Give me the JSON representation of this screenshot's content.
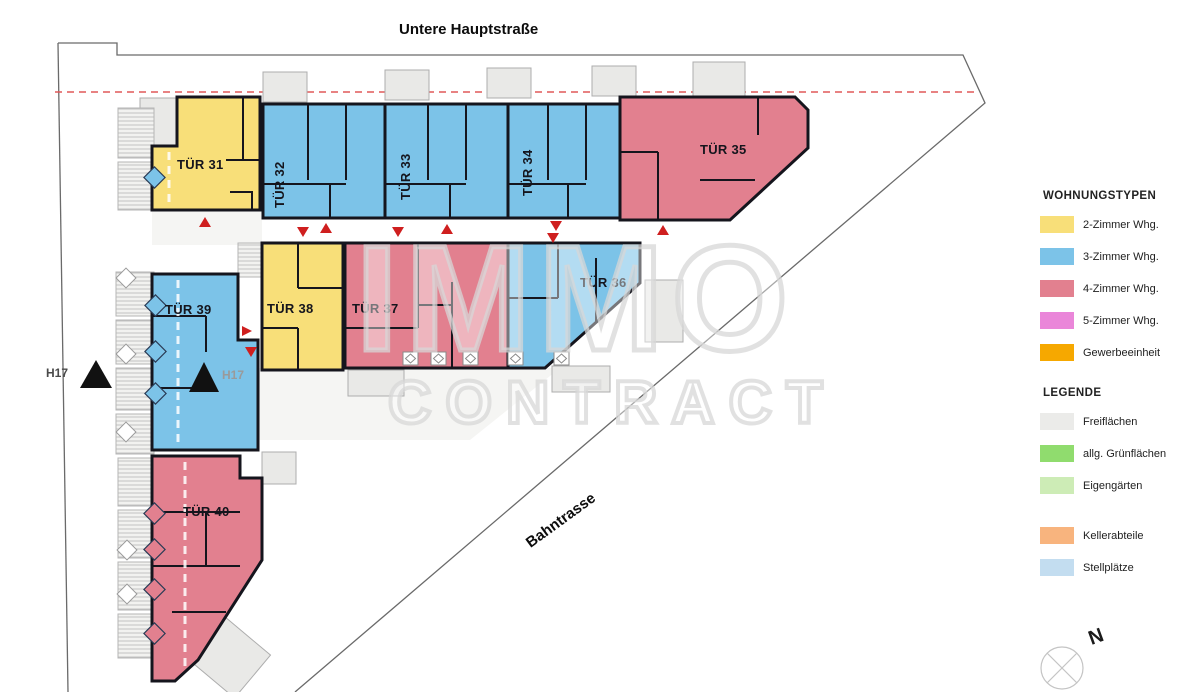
{
  "streets": {
    "top": "Untere Hauptstraße",
    "diagonal": "Bahntrasse"
  },
  "watermark": {
    "line1": "IMMO",
    "line2": "CONTRACT"
  },
  "compass": {
    "north_label": "N"
  },
  "house_labels": {
    "left": "H17",
    "right": "H17"
  },
  "units": [
    {
      "id": "tuer-31",
      "label": "TÜR 31",
      "type": "2-Zimmer Whg."
    },
    {
      "id": "tuer-32",
      "label": "TÜR 32",
      "type": "3-Zimmer Whg."
    },
    {
      "id": "tuer-33",
      "label": "TÜR 33",
      "type": "3-Zimmer Whg."
    },
    {
      "id": "tuer-34",
      "label": "TÜR 34",
      "type": "3-Zimmer Whg."
    },
    {
      "id": "tuer-35",
      "label": "TÜR 35",
      "type": "4-Zimmer Whg."
    },
    {
      "id": "tuer-36",
      "label": "TÜR 36",
      "type": "3-Zimmer Whg."
    },
    {
      "id": "tuer-37",
      "label": "TÜR 37",
      "type": "4-Zimmer Whg."
    },
    {
      "id": "tuer-38",
      "label": "TÜR 38",
      "type": "2-Zimmer Whg."
    },
    {
      "id": "tuer-39",
      "label": "TÜR 39",
      "type": "3-Zimmer Whg."
    },
    {
      "id": "tuer-40",
      "label": "TÜR 40",
      "type": "4-Zimmer Whg."
    }
  ],
  "legend": {
    "types_title": "WOHNUNGSTYPEN",
    "types": [
      {
        "label": "2-Zimmer Whg.",
        "color_key": "type2"
      },
      {
        "label": "3-Zimmer Whg.",
        "color_key": "type3"
      },
      {
        "label": "4-Zimmer Whg.",
        "color_key": "type4"
      },
      {
        "label": "5-Zimmer Whg.",
        "color_key": "type5"
      },
      {
        "label": "Gewerbeeinheit",
        "color_key": "gewerbe"
      }
    ],
    "areas_title": "LEGENDE",
    "areas": [
      {
        "label": "Freiflächen",
        "color_key": "frei"
      },
      {
        "label": "allg. Grünflächen",
        "color_key": "gruen"
      },
      {
        "label": "Eigengärten",
        "color_key": "eigen"
      },
      {
        "label": "Kellerabteile",
        "color_key": "keller"
      },
      {
        "label": "Stellplätze",
        "color_key": "stell"
      }
    ]
  },
  "colors": {
    "type2": "#f8df79",
    "type3": "#7cc3e8",
    "type4": "#e2808f",
    "type5": "#ea86d9",
    "gewerbe": "#f6a800",
    "frei": "#ebebe9",
    "gruen": "#90dc6e",
    "eigen": "#cdecb6",
    "keller": "#f8b47e",
    "stell": "#c3ddf0",
    "wall": "#15151d",
    "marker_red": "#cf1f1f"
  }
}
